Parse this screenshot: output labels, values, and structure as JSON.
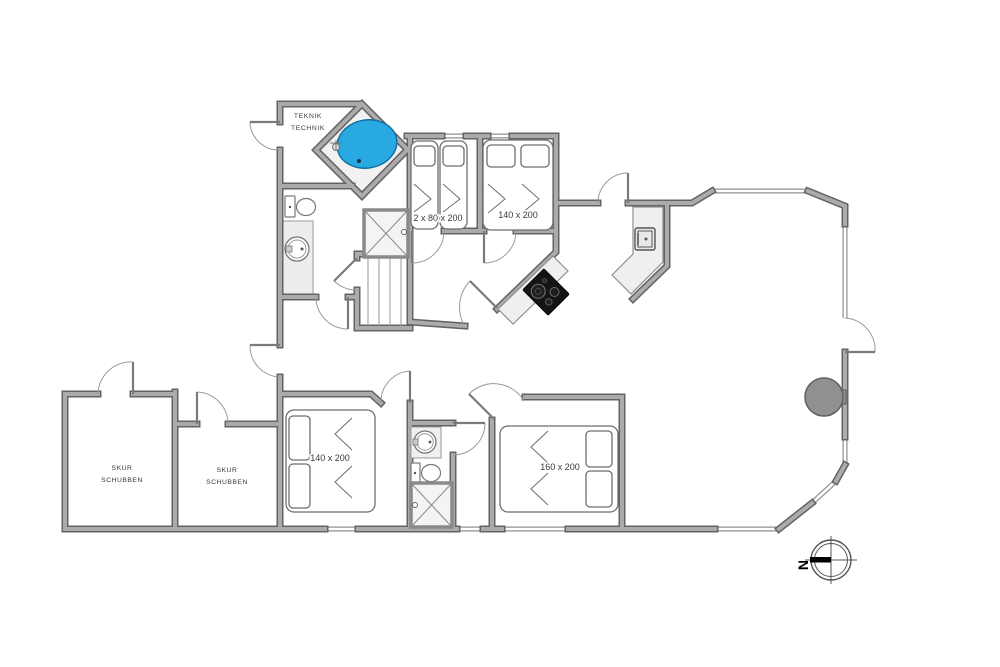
{
  "document_type": "floor-plan",
  "rooms": {
    "teknik": {
      "line1": "TEKNIK",
      "line2": "TECHNIK"
    },
    "shed1": {
      "line1": "SKUR",
      "line2": "SCHUBBEN"
    },
    "shed2": {
      "line1": "SKUR",
      "line2": "SCHUBBEN"
    }
  },
  "beds": {
    "twin_top": "2 x 80 x 200",
    "double_top": "140 x 200",
    "double_bottom_left": "140 x 200",
    "double_bottom_right": "160 x 200"
  },
  "compass": {
    "north": "N"
  },
  "colors": {
    "wall_fill": "#ababab",
    "wall_edge": "#636363",
    "window": "#8f8f8f",
    "spa_water": "#29a9e2",
    "cooktop": "#141414",
    "counter": "#efefef",
    "wet_floor": "#ededed",
    "fireplace": "#8f8f8f",
    "paper": "#ffffff"
  }
}
